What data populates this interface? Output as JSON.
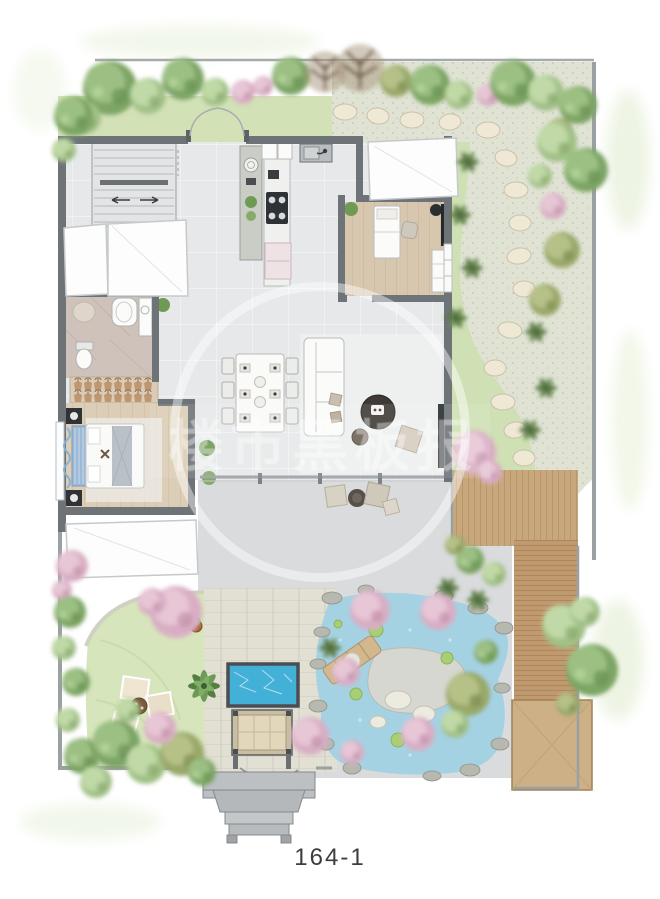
{
  "caption": {
    "text": "164-1"
  },
  "watermark": {
    "text": "楼市黑板报"
  },
  "palette": {
    "background": "#ffffff",
    "wall": "#6e7378",
    "floor_tile": "#e6e8e9",
    "wood_floor": "#d8c7af",
    "bedroom_wood": "#dccdb6",
    "bath_floor": "#cec2ba",
    "grass": "#d2e1b6",
    "lawn": "#d7e5bc",
    "gravel": "#e0e3d4",
    "stepping_stone": "#efe8d5",
    "deck_wood": "#cdb086",
    "pond_water": "#a5d2e3",
    "pool_water": "#43b0d8",
    "tree_green_dark": "#7da565",
    "tree_green_light": "#a2c188",
    "tree_olive": "#9aa86a",
    "tree_pink": "#d9aec4",
    "porch_stone": "#bcc0c3"
  }
}
